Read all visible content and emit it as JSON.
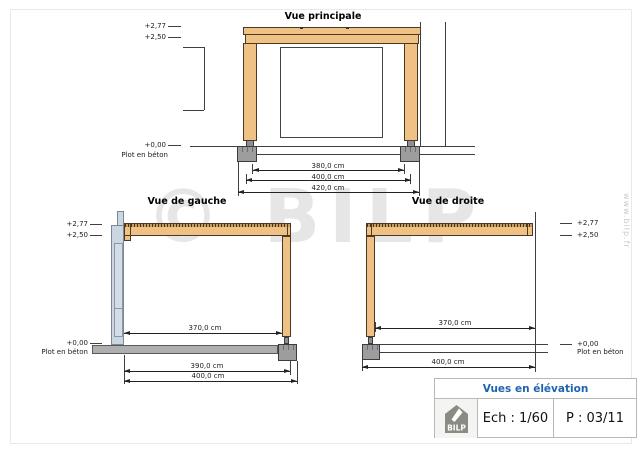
{
  "drawing": {
    "watermark_text": "© BILP",
    "website_vertical": "www.bilp.fr"
  },
  "vue_principale": {
    "title": "Vue principale",
    "level_277": "+2,77",
    "level_250": "+2,50",
    "level_0": "+0,00",
    "plot_label": "Plot en béton",
    "dim_380": "380,0 cm",
    "dim_400": "400,0 cm",
    "dim_420": "420,0 cm"
  },
  "vue_gauche": {
    "title": "Vue de gauche",
    "level_277": "+2,77",
    "level_250": "+2,50",
    "level_0": "+0,00",
    "plot_label": "Plot en béton",
    "dim_370": "370,0 cm",
    "dim_390": "390,0 cm",
    "dim_400": "400,0 cm"
  },
  "vue_droite": {
    "title": "Vue de droite",
    "level_277": "+2,77",
    "level_250": "+2,50",
    "level_0": "+0,00",
    "plot_label": "Plot en béton",
    "dim_370": "370,0 cm",
    "dim_400": "400,0 cm"
  },
  "title_block": {
    "title": "Vues en élévation",
    "scale": "Ech : 1/60",
    "page": "P : 03/11",
    "logo": "BILP"
  },
  "colors": {
    "wood": "#F0C184",
    "wall": "#CBD6E0",
    "concrete": "#9D9D9D",
    "slab": "#AFAFAF",
    "accent_blue": "#1D64B0",
    "line": "#3f3f3f",
    "watermark": "#E6E6E6"
  }
}
